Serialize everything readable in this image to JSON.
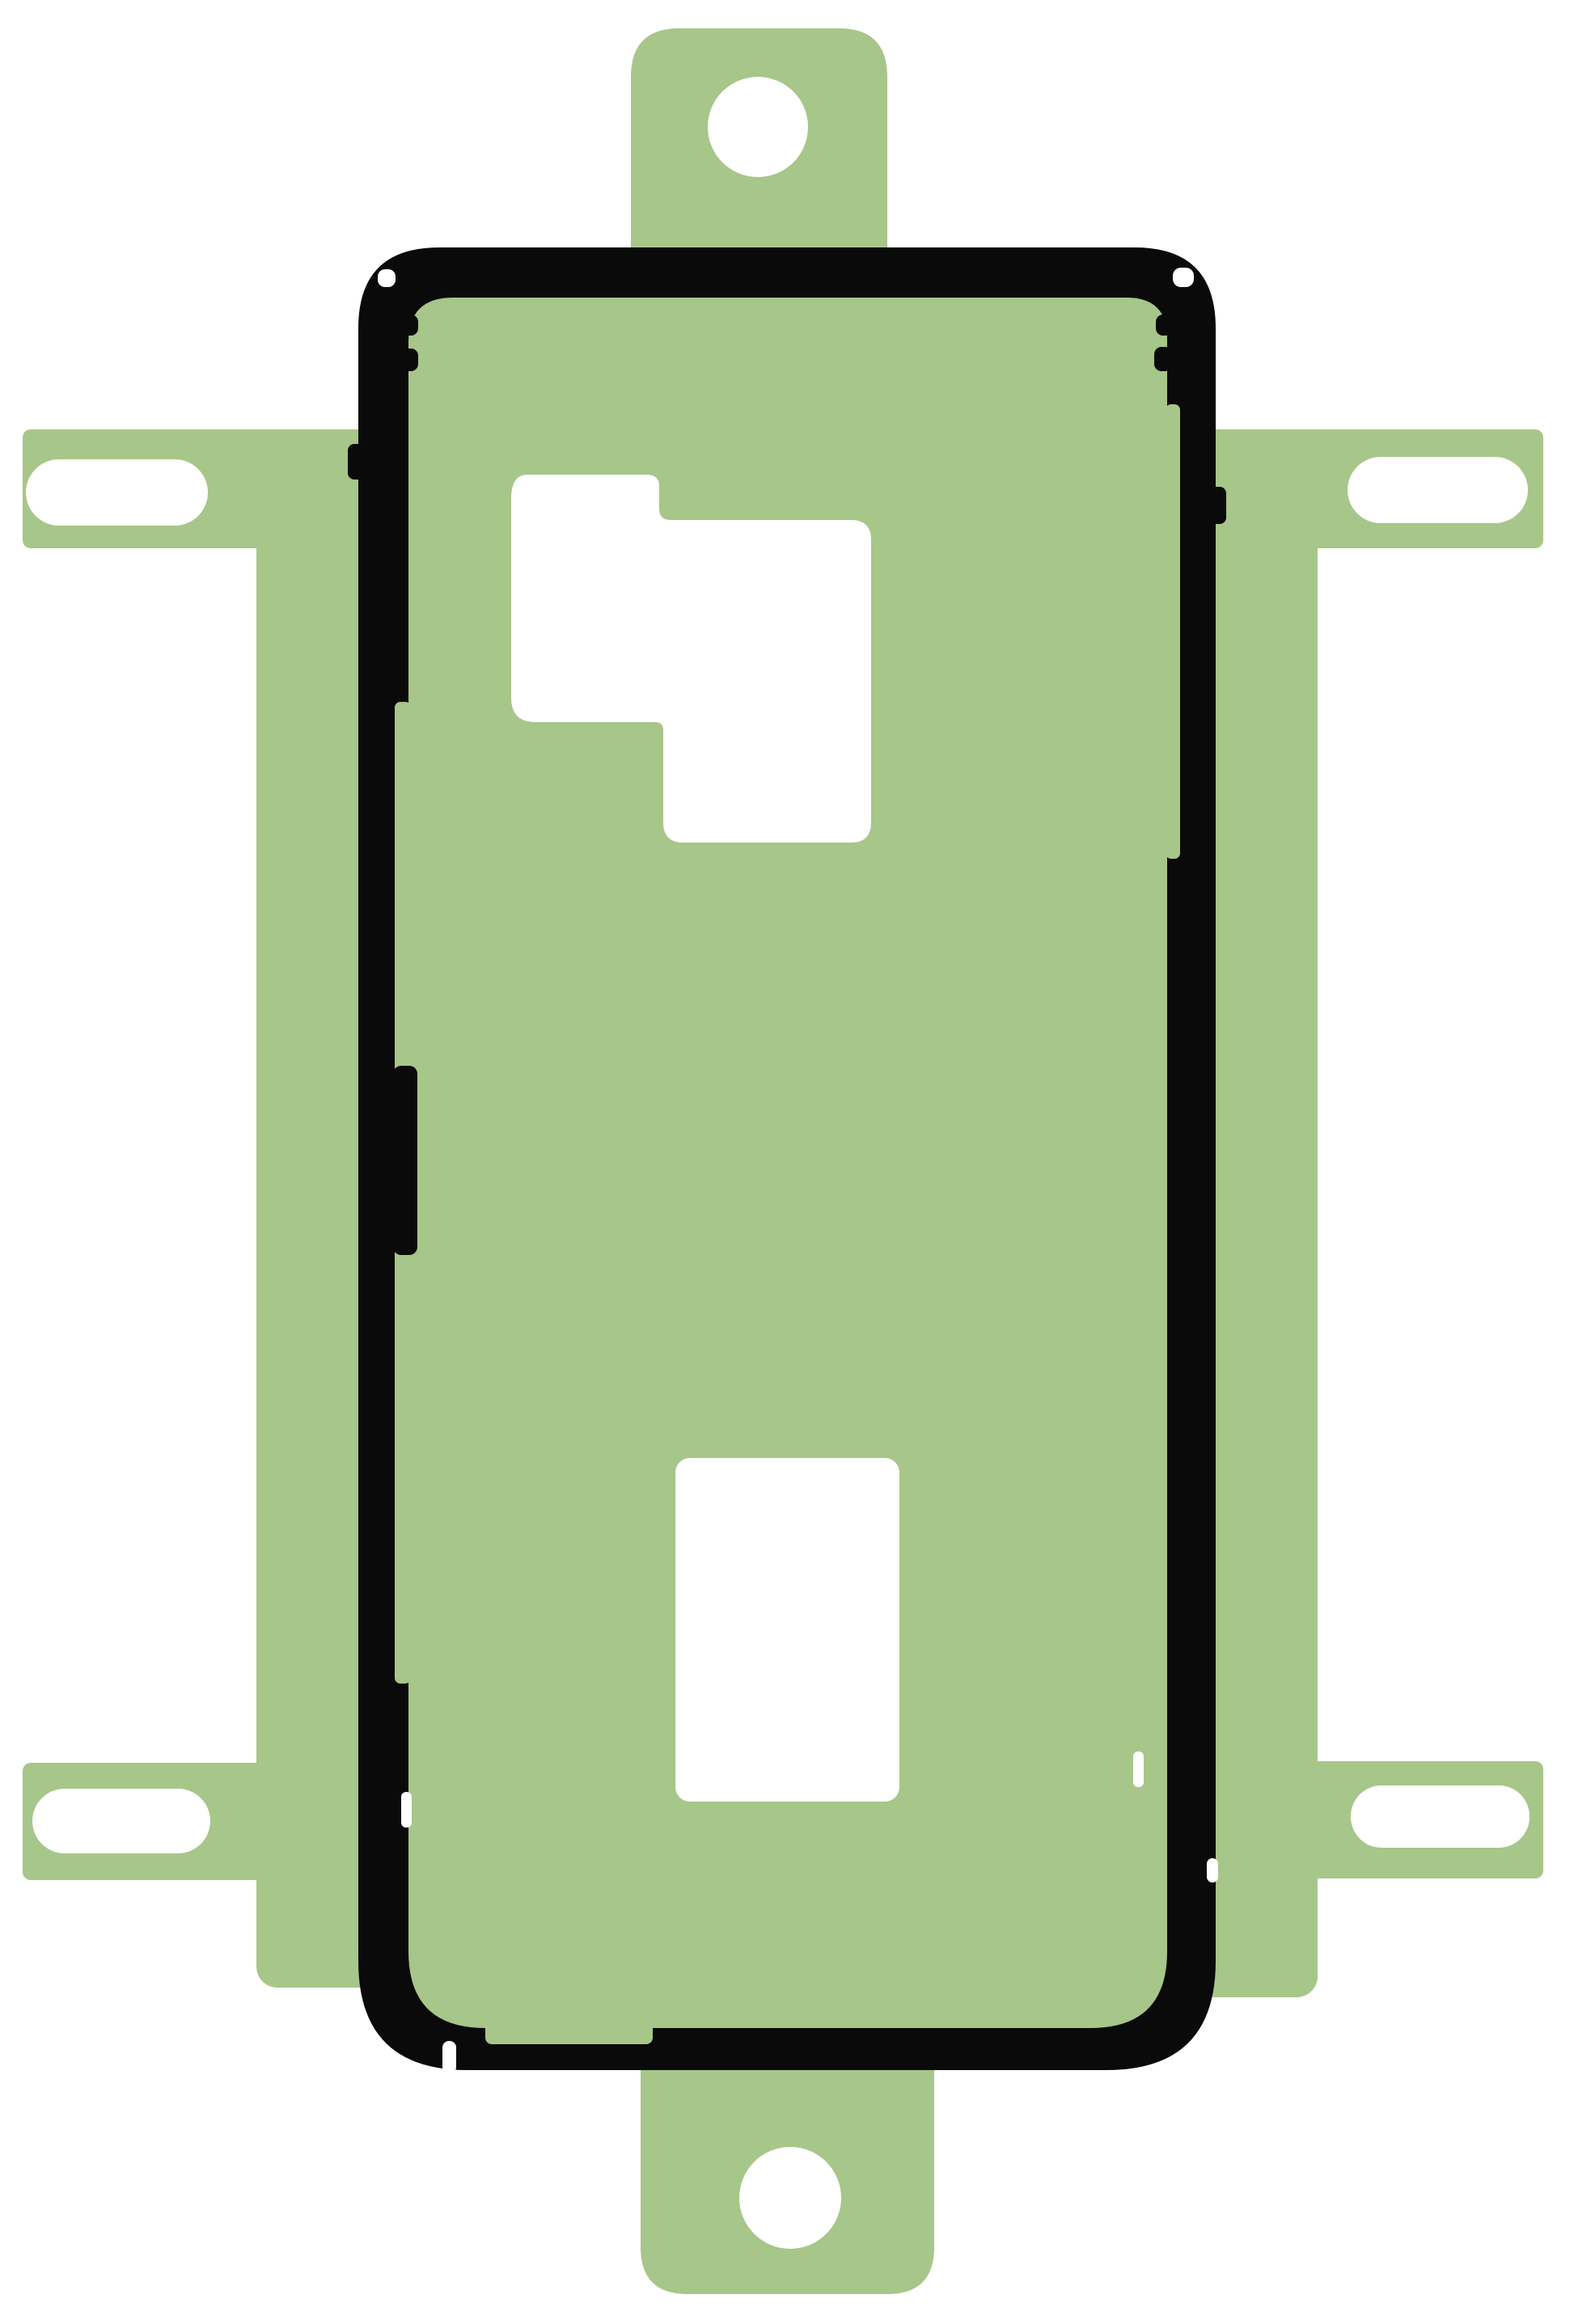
{
  "figure": {
    "subject": "phone-back-cover-adhesive-sticker-on-liner-sheet",
    "tabs": 2,
    "screw_holes": 2,
    "rail_slots": 4,
    "die_cut_openings": 2
  },
  "colors": {
    "background": "#ffffff",
    "liner_green": "#a7c689",
    "adhesive_black": "#0a0a0a",
    "cutout_white": "#ffffff"
  }
}
